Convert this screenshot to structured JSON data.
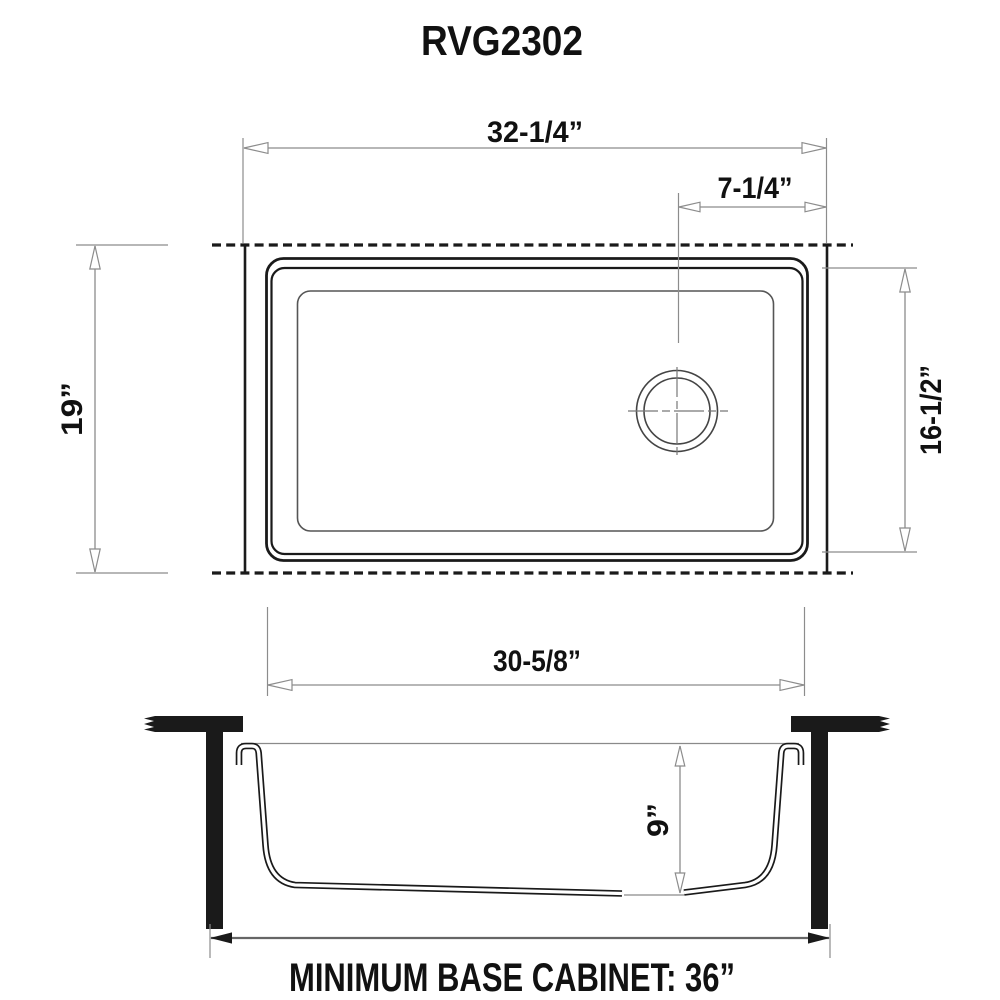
{
  "title": "RVG2302",
  "top_view": {
    "overall_width": "32-1/4”",
    "drain_offset": "7-1/4”",
    "front_to_back": "19”",
    "bowl_front_to_back": "16-1/2”",
    "bowl_width": "30-5/8”"
  },
  "side_view": {
    "bowl_depth": "9”",
    "cabinet_note": "MINIMUM BASE CABINET: 36”"
  },
  "colors": {
    "drawing_line": "#1a1a1a",
    "dimension_line": "#8c8c8c",
    "text": "#111111",
    "background": "#ffffff"
  }
}
